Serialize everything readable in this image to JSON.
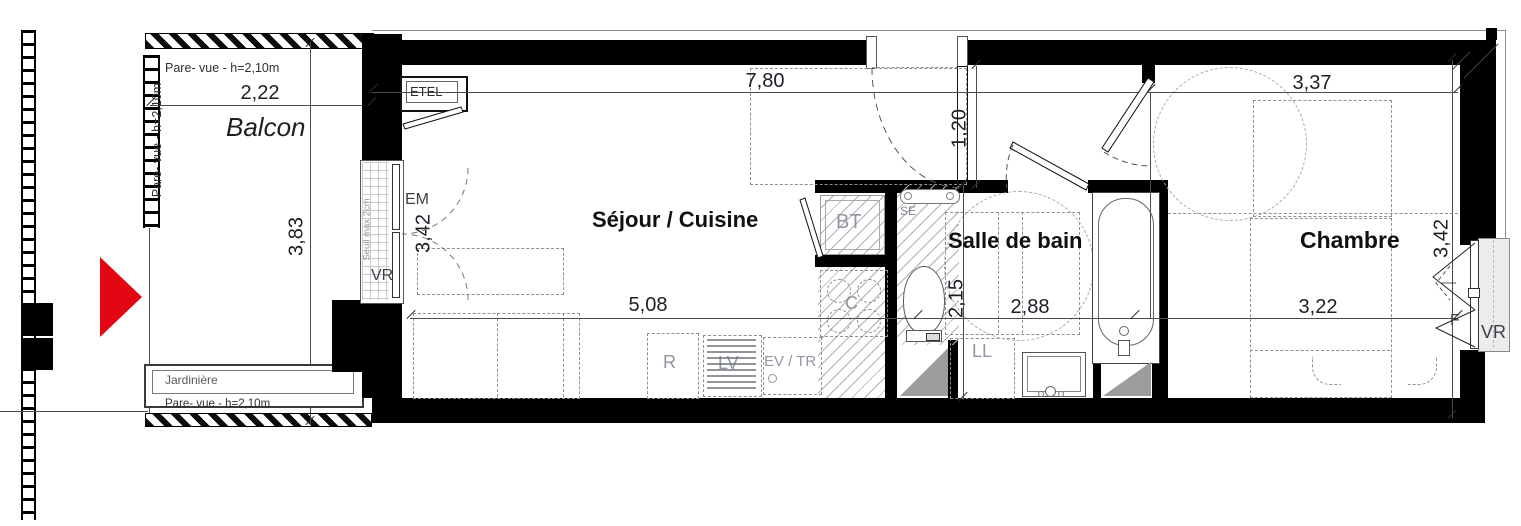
{
  "colors": {
    "wall": "#000000",
    "entry_arrow_red": "#e30613",
    "dim_text": "#1d1f27",
    "label_gray": "#9097a3",
    "label_dark": "#3c3f46"
  },
  "balcony": {
    "label": "Balcon",
    "pare_vue_top": "Pare- vue - h=2,10m",
    "pare_vue_left": "Pare- vue - h=2,10m",
    "pare_vue_bottom": "Pare- vue - h=2,10m",
    "jardiniere": "Jardinière",
    "dim_width": "2,22",
    "dim_depth": "3,83"
  },
  "living": {
    "label": "Séjour / Cuisine",
    "dim_top": "7,80",
    "dim_bottom": "5,08",
    "dim_bay": "3,42",
    "dim_door": "1,20",
    "etel": "ETEL",
    "em": "EM",
    "vr": "VR",
    "seuil": "Seuil max 2cm"
  },
  "kitchen": {
    "fridge": "R",
    "dishwasher": "LV",
    "sink": "EV / TR",
    "hob": "C",
    "water_heater": "BT"
  },
  "bathroom": {
    "label": "Salle de bain",
    "dim_width": "2,88",
    "dim_depth": "2,15",
    "towel_dryer": "SE",
    "washing_machine": "LL"
  },
  "bedroom": {
    "label": "Chambre",
    "dim_top": "3,37",
    "dim_bottom": "3,22",
    "dim_depth": "3,42",
    "window": "F",
    "shutter": "VR"
  }
}
